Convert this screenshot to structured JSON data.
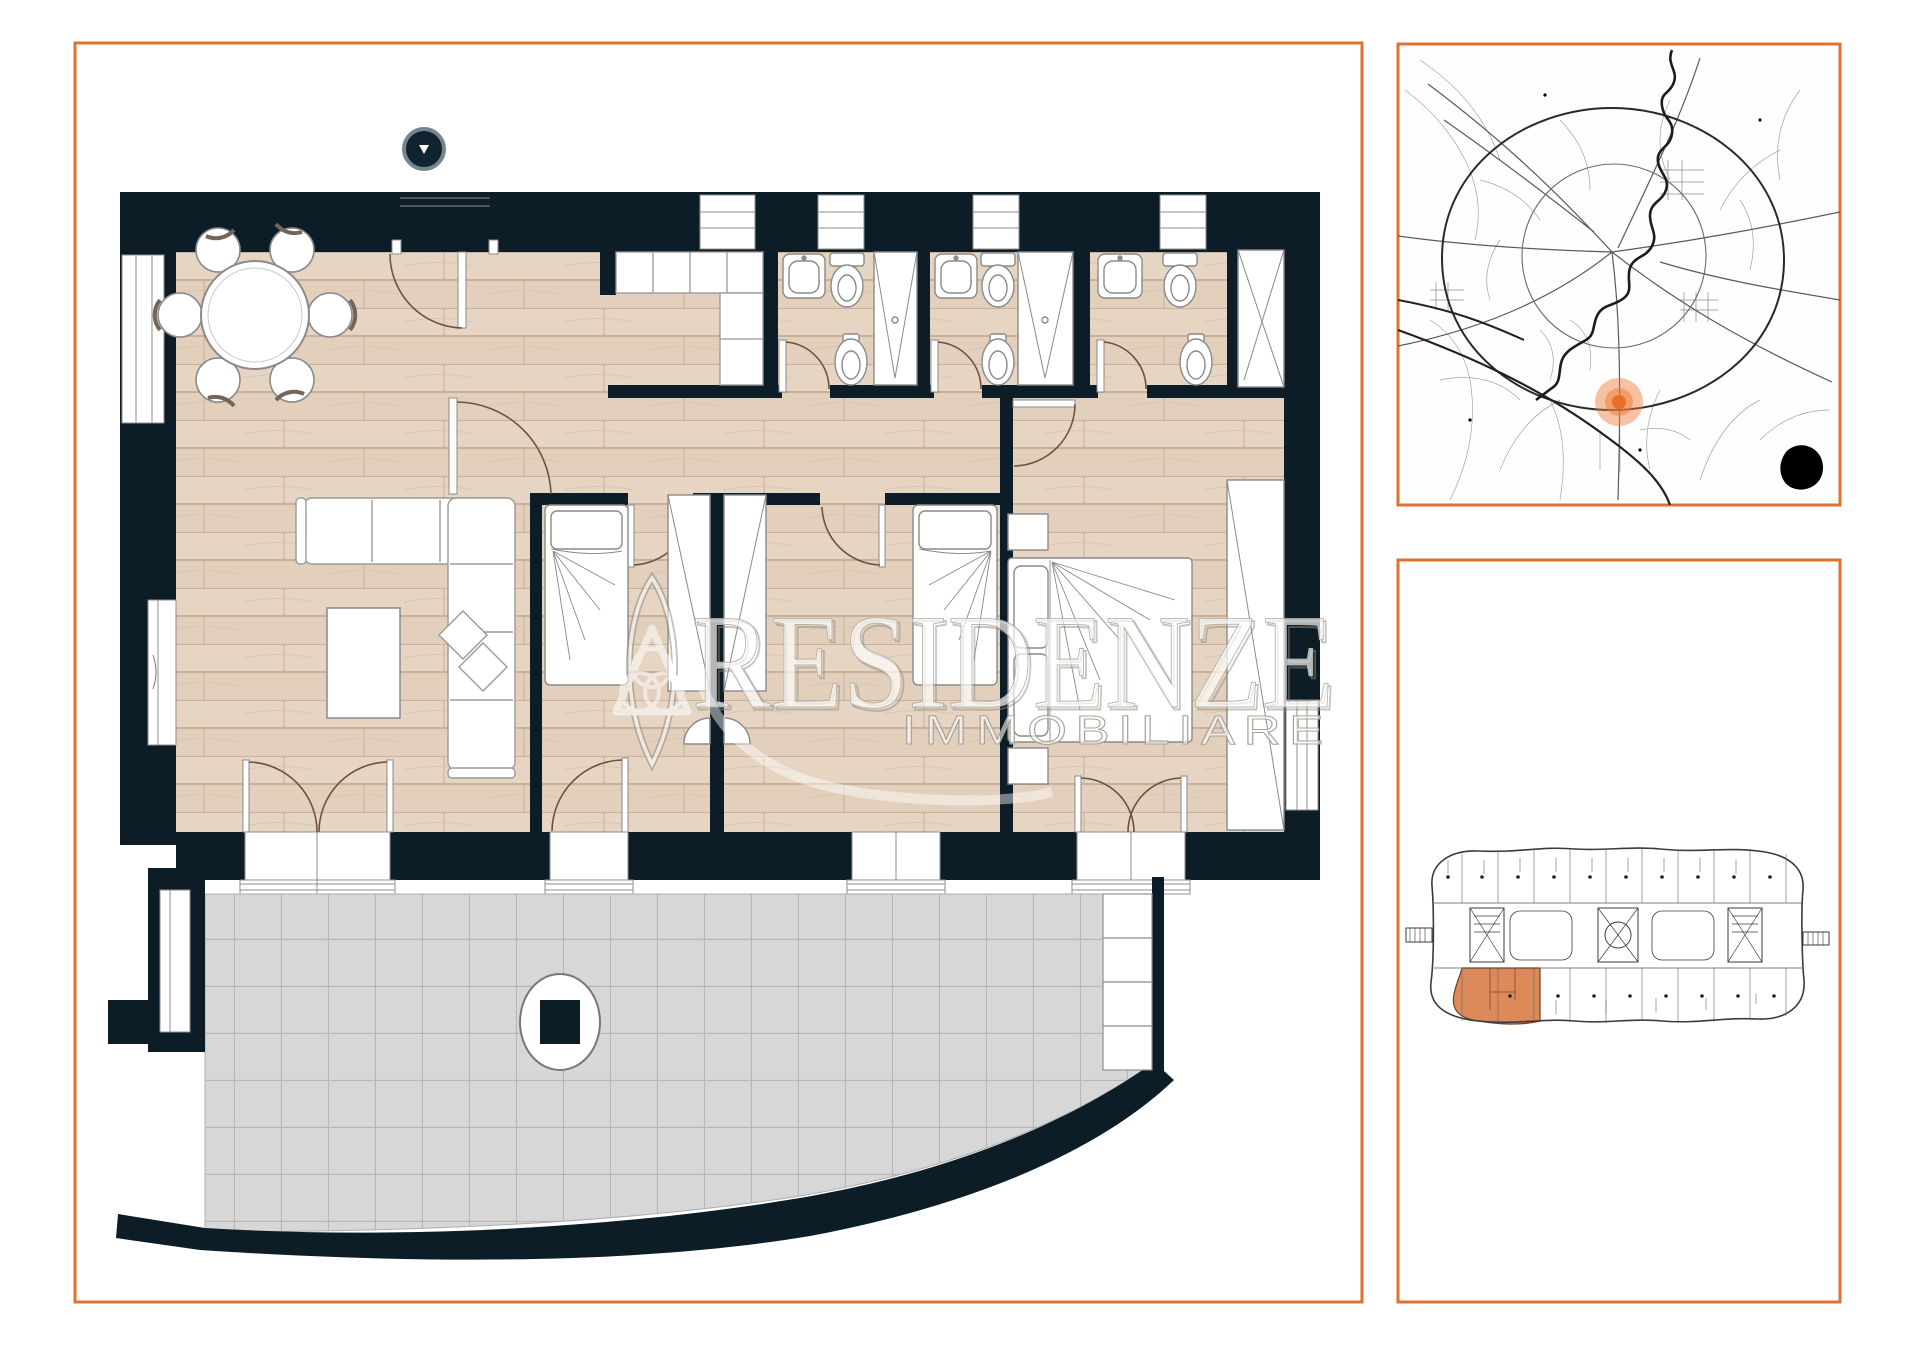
{
  "watermark": {
    "line1": "RESIDENZE",
    "line2": "IMMOBILIARE"
  },
  "colors": {
    "accent_orange_border": "#e0722d",
    "wall_dark": "#0d1d27",
    "wood_floor": "#e6d5c3",
    "terrace_tile": "#d7d7d7",
    "map_marker_orange": "#e8762f",
    "key_plan_unit_highlight": "#dc8a59"
  },
  "panels": {
    "floor_plan": {
      "has_watermark": true
    },
    "location_map": {
      "marker_visible": true
    },
    "building_key_plan": {
      "unit_highlighted": true
    }
  }
}
